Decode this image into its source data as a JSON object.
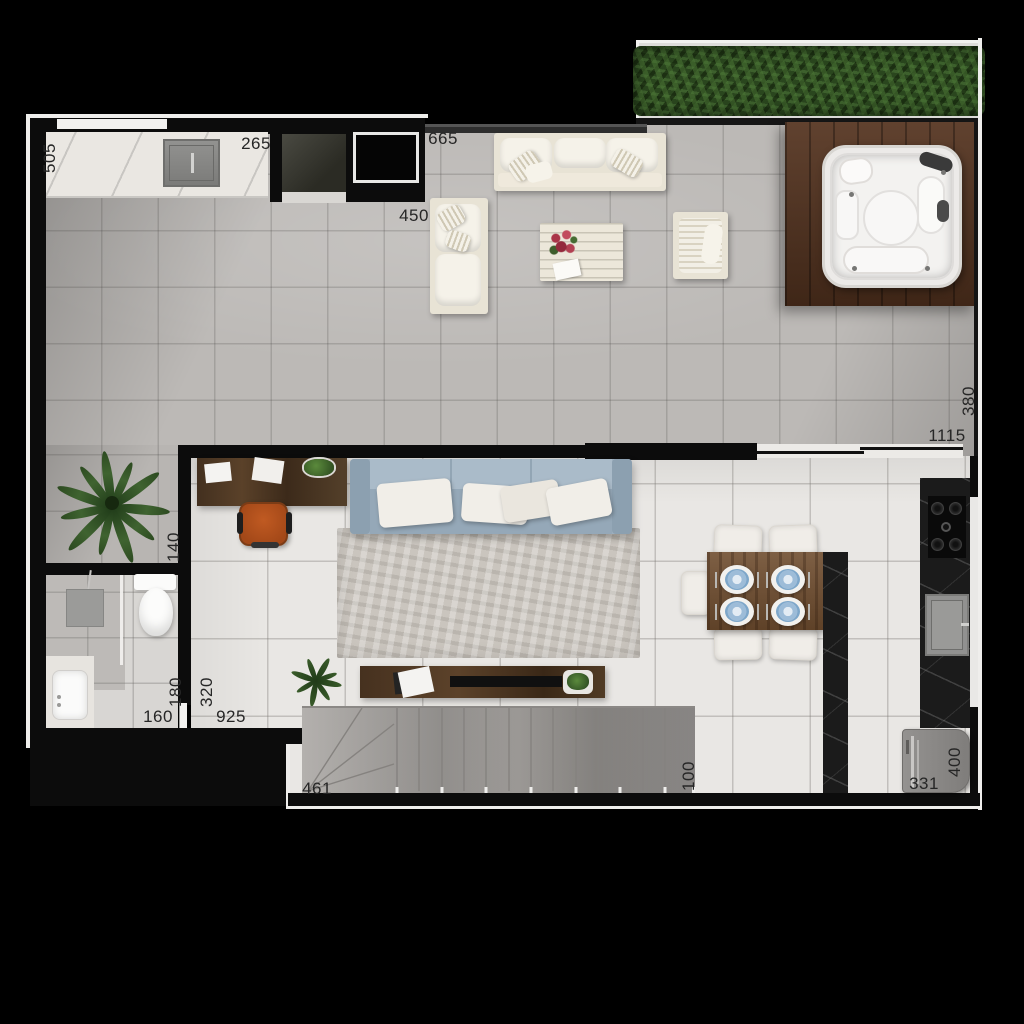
{
  "canvas": {
    "width": 1024,
    "height": 1024,
    "background": "#000000"
  },
  "dimensions": [
    {
      "text": "505",
      "orientation": "vertical"
    },
    {
      "text": "265",
      "orientation": "horizontal"
    },
    {
      "text": "665",
      "orientation": "horizontal"
    },
    {
      "text": "450",
      "orientation": "horizontal"
    },
    {
      "text": "380",
      "orientation": "vertical"
    },
    {
      "text": "1115",
      "orientation": "horizontal"
    },
    {
      "text": "140",
      "orientation": "vertical"
    },
    {
      "text": "180",
      "orientation": "vertical"
    },
    {
      "text": "320",
      "orientation": "vertical"
    },
    {
      "text": "160",
      "orientation": "horizontal"
    },
    {
      "text": "925",
      "orientation": "horizontal"
    },
    {
      "text": "461",
      "orientation": "horizontal"
    },
    {
      "text": "100",
      "orientation": "vertical"
    },
    {
      "text": "331",
      "orientation": "horizontal"
    },
    {
      "text": "400",
      "orientation": "vertical"
    }
  ],
  "colors": {
    "background": "#000000",
    "wall": "#0c0c0c",
    "outline": "#efeeec",
    "terrace_floor": "#bcb9b6",
    "living_floor": "#e9e7e4",
    "bath_floor": "#d8d6d3",
    "hedge_green": "#2a461e",
    "deck_wood": "#54331f",
    "cream_furniture": "#e8e3d5",
    "sofa_blue_gray": "#9dafbe",
    "chair_orange": "#b5521f",
    "table_wood": "#6f4d2f",
    "marble_dark": "#1b1b1b",
    "plate_blue": "#7da6c9",
    "stairs_gray": "#a5a2a0"
  },
  "components": [
    "terrace",
    "planter-hedge",
    "wood-deck",
    "hot-tub",
    "outdoor-sofa",
    "outdoor-loveseat",
    "outdoor-armchair",
    "outdoor-coffee-table",
    "gourmet-counter",
    "gourmet-sink",
    "stone-cooktop-slab",
    "built-in-appliance",
    "palm-plant",
    "bathroom",
    "shower-drain",
    "toilet",
    "vanity-basin",
    "desk",
    "office-chair",
    "living-sofa",
    "area-rug",
    "tv-console",
    "dining-table",
    "dining-chairs",
    "kitchen-island",
    "kitchen-counter",
    "gas-cooktop",
    "kitchen-sink",
    "stairs",
    "laundry-appliance"
  ]
}
